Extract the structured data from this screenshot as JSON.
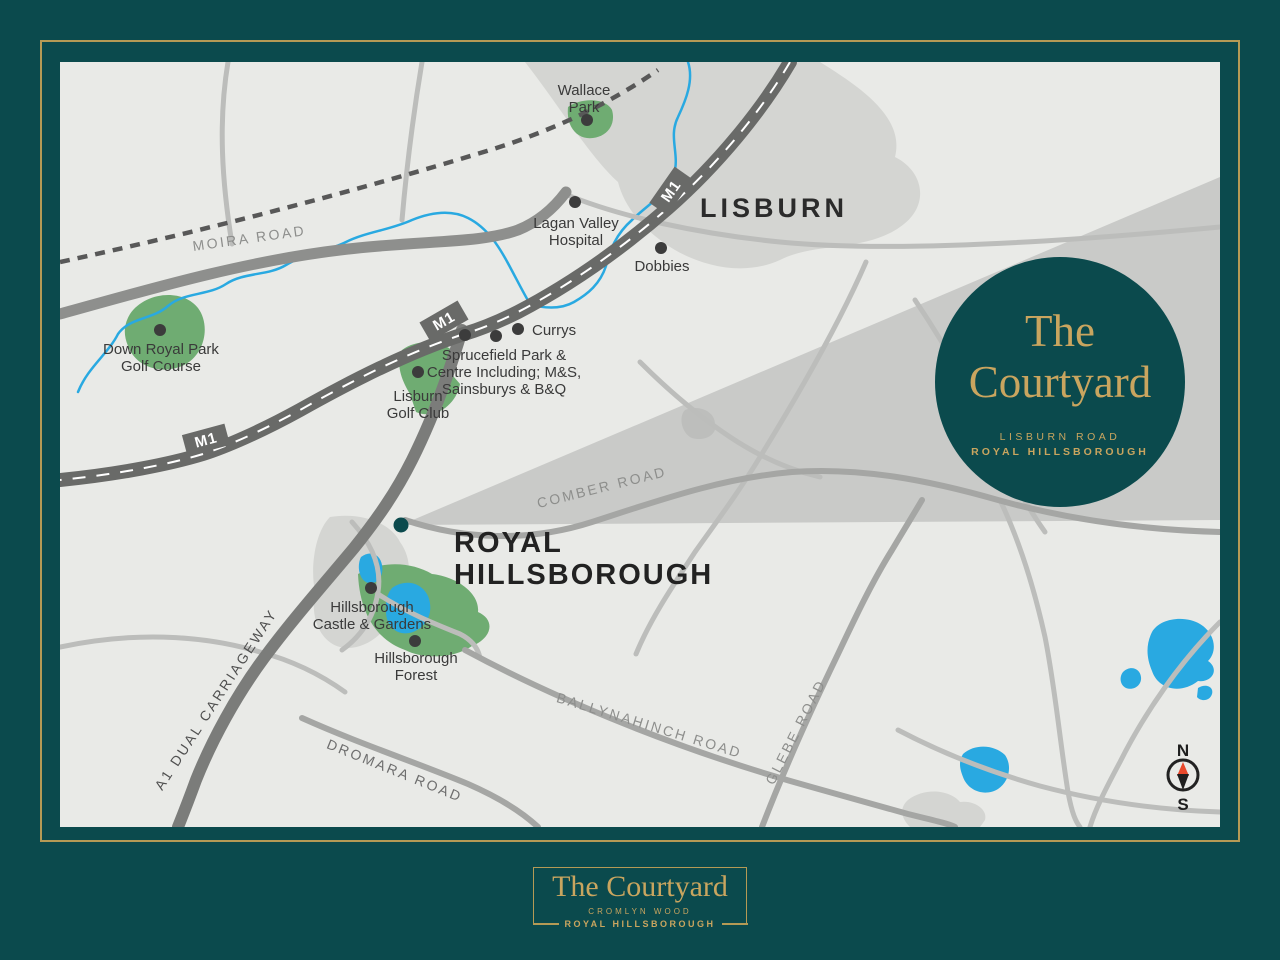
{
  "colors": {
    "teal": "#0B4A4D",
    "gold": "#B59A55",
    "gold_light": "#C9A55F",
    "map_bg": "#E9EAE7",
    "urban": "#D4D5D2",
    "green": "#6FAC72",
    "water": "#29A9E1",
    "road_major": "#696A68",
    "label": "#3A3A3A"
  },
  "map": {
    "towns": {
      "lisburn": "LISBURN",
      "royal": [
        "ROYAL",
        "HILLSBOROUGH"
      ]
    },
    "pois": {
      "wallace_park": [
        "Wallace",
        "Park"
      ],
      "lagan_valley_hospital": [
        "Lagan Valley",
        "Hospital"
      ],
      "dobbies": [
        "Dobbies"
      ],
      "currys": [
        "Currys"
      ],
      "sprucefield": [
        "Sprucefield Park &",
        "Centre Including; M&S,",
        "Sainsburys & B&Q"
      ],
      "lisburn_golf_club": [
        "Lisburn",
        "Golf Club"
      ],
      "down_royal_park": [
        "Down Royal Park",
        "Golf Course"
      ],
      "hillsborough_castle": [
        "Hillsborough",
        "Castle & Gardens"
      ],
      "hillsborough_forest": [
        "Hillsborough",
        "Forest"
      ]
    },
    "roads": {
      "moira": "MOIRA ROAD",
      "comber": "COMBER ROAD",
      "a1": "A1 DUAL CARRIAGEWAY",
      "ballynahinch": "BALLYNAHINCH ROAD",
      "glebe": "GLEBE ROAD",
      "dromara": "DROMARA ROAD",
      "m1": "M1"
    },
    "compass": {
      "north": "N",
      "south": "S"
    }
  },
  "badge": {
    "title": [
      "The",
      "Courtyard"
    ],
    "address": [
      "LISBURN ROAD",
      "ROYAL HILLSBOROUGH"
    ]
  },
  "footer": {
    "title": "The Courtyard",
    "estate": "CROMLYN WOOD",
    "location": "ROYAL HILLSBOROUGH"
  }
}
